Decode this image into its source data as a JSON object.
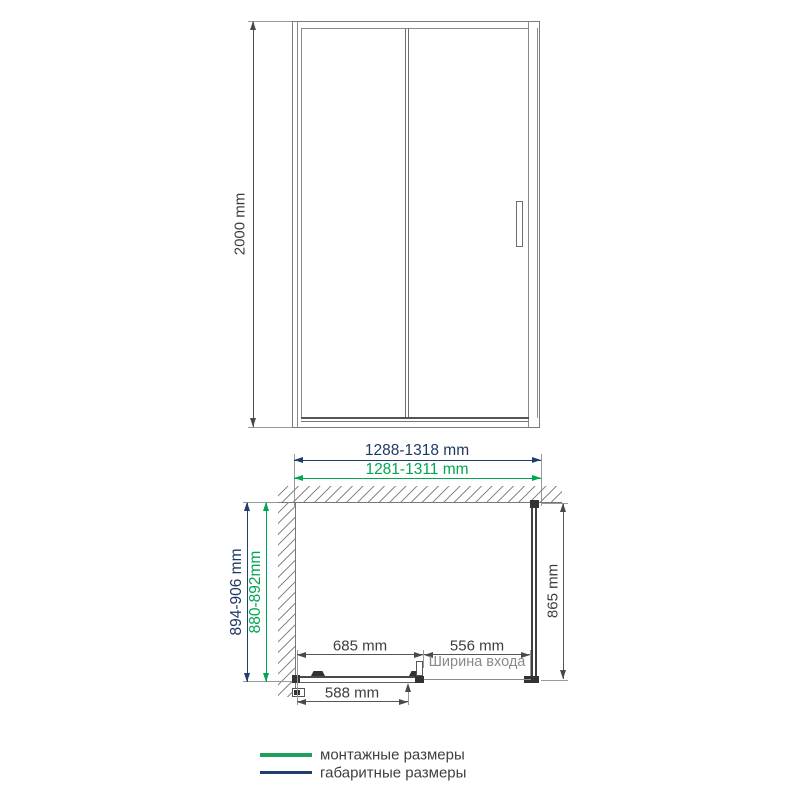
{
  "drawing": {
    "front_view": {
      "height": "2000 mm"
    },
    "width_dims": {
      "overall": "1288-1318 mm",
      "mounting": "1281-1311 mm"
    },
    "plan_view": {
      "depth_overall": "894-906 mm",
      "depth_mounting": "880-892mm",
      "side_panel": "865 mm",
      "door_rail": "685 mm",
      "entrance": "556 mm",
      "entrance_caption": "Ширина входа",
      "glass": "588 mm"
    },
    "legend": {
      "mounting": {
        "label": "монтажные размеры",
        "color": "#1FA05E"
      },
      "overall": {
        "label": "габаритные размеры",
        "color": "#1F3D6D"
      }
    },
    "colors": {
      "mounting_green": "#00A651",
      "overall_navy": "#1F3864",
      "line_gray": "#6E6E6E",
      "text_gray": "#3D3D3D",
      "hardware_dark": "#333333"
    }
  }
}
